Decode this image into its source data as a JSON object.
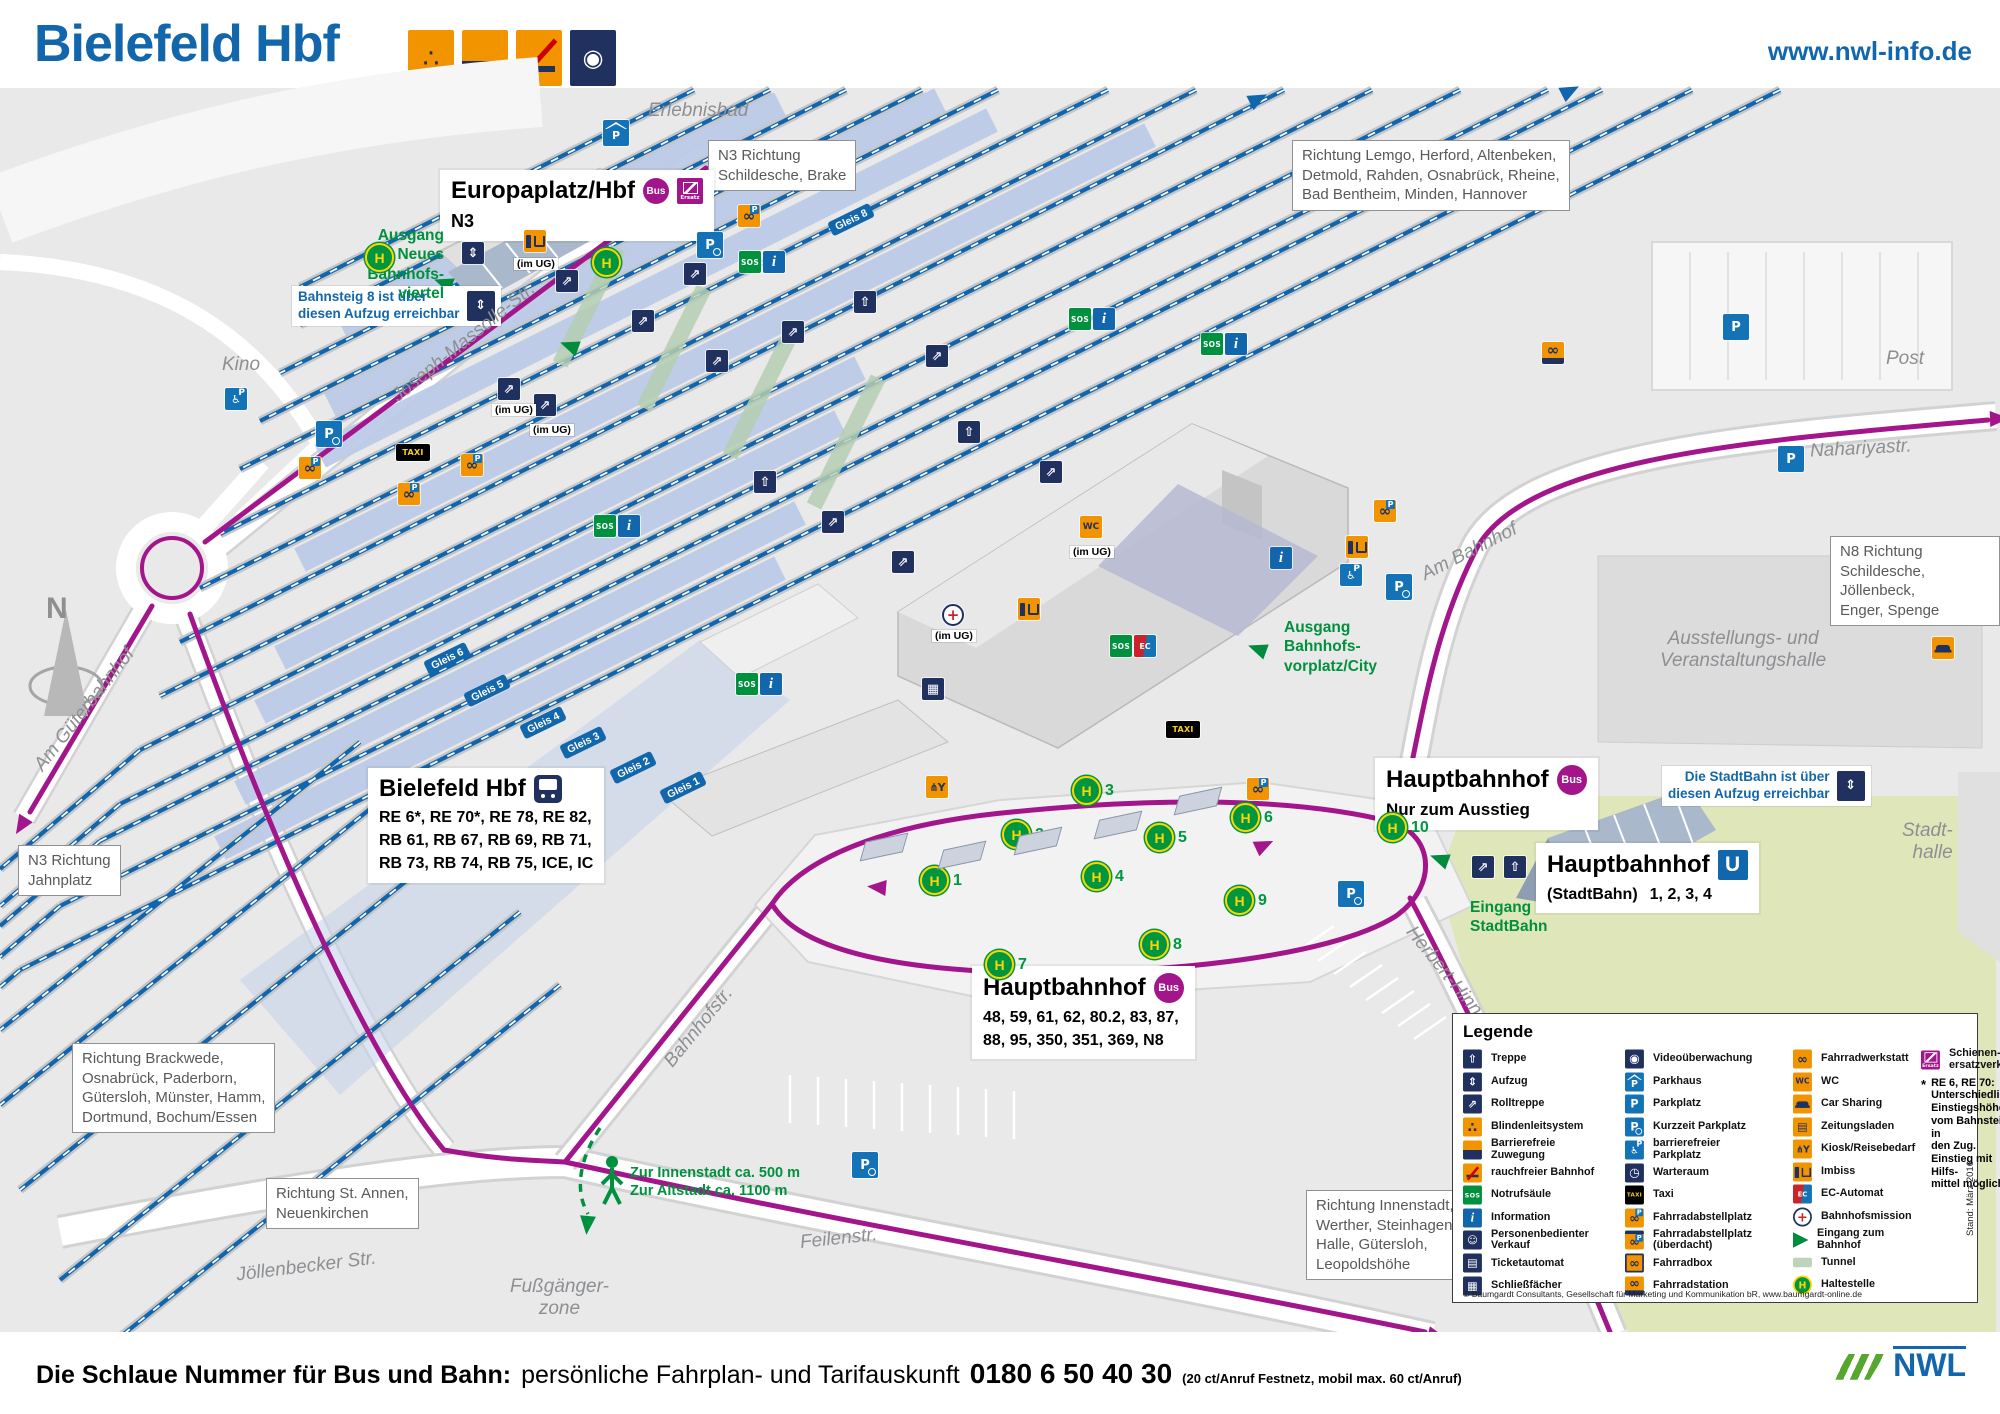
{
  "header": {
    "title": "Bielefeld Hbf",
    "website": "www.nwl-info.de"
  },
  "map": {
    "compass": "N",
    "taxi": "TAXI",
    "im_ug": "(im UG)",
    "gleis": [
      "Gleis 8",
      "Gleis 6",
      "Gleis 5",
      "Gleis 4",
      "Gleis 3",
      "Gleis 2",
      "Gleis 1"
    ],
    "stops": [
      "1",
      "2",
      "3",
      "4",
      "5",
      "6",
      "7",
      "8",
      "9",
      "10"
    ],
    "stations": {
      "europaplatz": {
        "title": "Europaplatz/Hbf",
        "badge": "Bus",
        "line": "N3"
      },
      "bielefeld": {
        "title": "Bielefeld Hbf",
        "lines": "RE 6*, RE 70*, RE 78, RE 82,\nRB 61, RB 67, RB 69, RB 71,\nRB 73, RB 74, RB 75, ICE, IC"
      },
      "hbf_exit": {
        "title": "Hauptbahnhof",
        "badge": "Bus",
        "note": "Nur zum Ausstieg"
      },
      "hbf_u": {
        "title": "Hauptbahnhof",
        "badge": "U",
        "sub": "(StadtBahn)",
        "lines": "1, 2, 3, 4"
      },
      "hbf_bus": {
        "title": "Hauptbahnhof",
        "badge": "Bus",
        "lines": "48, 59, 61, 62, 80.2, 83, 87,\n88, 95, 350, 351, 369, N8"
      }
    },
    "directions": {
      "lemgo": "Richtung Lemgo, Herford, Altenbeken,\nDetmold, Rahden, Osnabrück, Rheine,\nBad Bentheim, Minden, Hannover",
      "n3_schildesche": "N3 Richtung\nSchildesche, Brake",
      "n3_jahnplatz": "N3 Richtung\nJahnplatz",
      "brackwede": "Richtung Brackwede,\nOsnabrück, Paderborn,\nGütersloh, Münster, Hamm,\nDortmund, Bochum/Essen",
      "st_annen": "Richtung St. Annen,\nNeuenkirchen",
      "innenstadt": "Richtung Innenstadt,\nWerther, Steinhagen,\nHalle, Gütersloh,\nLeopoldshöhe",
      "n8_schildesche": "N8 Richtung\nSchildesche, Jöllenbeck,\nEnger, Spenge"
    },
    "notes": {
      "bahnsteig8": "Bahnsteig 8 ist über\ndiesen Aufzug erreichbar",
      "stadtbahn": "Die StadtBahn ist über\ndiesen Aufzug erreichbar"
    },
    "green": {
      "viertel": "Ausgang\nNeues Bahnhofs-\nviertel",
      "vorplatz": "Ausgang\nBahnhofs-\nvorplatz/City",
      "eingang_sb": "Eingang\nStadtBahn",
      "walk": "Zur Innenstadt ca. 500 m\nZur Altstadt ca. 1100 m"
    },
    "places": {
      "erlebnisbad": "Erlebnisbad",
      "kino": "Kino",
      "post": "Post",
      "nahariya": "Nahariyastr.",
      "ausstellung": "Ausstellungs- und\nVeranstaltungshalle",
      "stadthalle": "Stadt-\nhalle",
      "am_gueterbahnhof": "Am Güterbahnhof",
      "joseph": "Joseph-Massolle-Str.",
      "bahnhofstr": "Bahnhofstr.",
      "feilenstr": "Feilenstr.",
      "joellenbecker": "Jöllenbecker Str.",
      "am_bahnhof": "Am Bahnhof",
      "herbert": "Herbert-Hinnen",
      "fussgaenger": "Fußgänger-\nzone"
    }
  },
  "legend": {
    "title": "Legende",
    "col1": [
      {
        "icon": "treppe",
        "label": "Treppe"
      },
      {
        "icon": "aufzug",
        "label": "Aufzug"
      },
      {
        "icon": "rolltreppe",
        "label": "Rolltreppe"
      },
      {
        "icon": "blinden",
        "label": "Blindenleitsystem"
      },
      {
        "icon": "barrierefrei",
        "label": "Barrierefreie\nZuwegung"
      },
      {
        "icon": "rauchfrei",
        "label": "rauchfreier Bahnhof"
      },
      {
        "icon": "sos",
        "label": "Notrufsäule"
      },
      {
        "icon": "info",
        "label": "Information"
      },
      {
        "icon": "verkauf",
        "label": "Personenbedienter\nVerkauf"
      },
      {
        "icon": "ticket",
        "label": "Ticketautomat"
      },
      {
        "icon": "locker",
        "label": "Schließfächer"
      }
    ],
    "col2": [
      {
        "icon": "video",
        "label": "Videoüberwachung"
      },
      {
        "icon": "parkhaus",
        "label": "Parkhaus"
      },
      {
        "icon": "p",
        "label": "Parkplatz"
      },
      {
        "icon": "pclock",
        "label": "Kurzzeit Parkplatz"
      },
      {
        "icon": "bfp",
        "label": "barrierefreier\nParkplatz"
      },
      {
        "icon": "warte",
        "label": "Warteraum"
      },
      {
        "icon": "taxi",
        "label": "Taxi"
      },
      {
        "icon": "bikep",
        "label": "Fahrradabstellplatz"
      },
      {
        "icon": "bikeproof",
        "label": "Fahrradabstellplatz\n(überdacht)"
      },
      {
        "icon": "bikebox",
        "label": "Fahrradbox"
      },
      {
        "icon": "bikestation",
        "label": "Fahrradstation"
      }
    ],
    "col3": [
      {
        "icon": "bikewerk",
        "label": "Fahrradwerkstatt"
      },
      {
        "icon": "wc",
        "label": "WC"
      },
      {
        "icon": "car",
        "label": "Car Sharing"
      },
      {
        "icon": "zeitung",
        "label": "Zeitungsladen"
      },
      {
        "icon": "kiosk",
        "label": "Kiosk/Reisebedarf"
      },
      {
        "icon": "imbiss",
        "label": "Imbiss"
      },
      {
        "icon": "ec",
        "label": "EC-Automat"
      },
      {
        "icon": "mission",
        "label": "Bahnhofsmission"
      },
      {
        "icon": "eingang",
        "label": "Eingang zum\nBahnhof"
      },
      {
        "icon": "tunnel",
        "label": "Tunnel"
      },
      {
        "icon": "haltestelle",
        "label": "Haltestelle"
      }
    ],
    "col4_icon": "ersatz",
    "col4_label": "Schienen-\nersatzverkehr",
    "note_star": "*",
    "note_title": "RE 6, RE 70:",
    "note_body": "Unterschiedliche\nEinstiegshöhen\nvom Bahnsteig in\nden Zug.\nEinstieg mit Hilfs-\nmittel möglich.",
    "copyright": "© Baumgardt Consultants, Gesellschaft für Marketing und Kommunikation bR, www.baumgardt-online.de",
    "stand": "Stand: März 2016"
  },
  "footer": {
    "bold": "Die Schlaue Nummer für Bus und Bahn:",
    "regular": "persönliche Fahrplan- und Tarifauskunft",
    "phone": "0180 6 50 40 30",
    "small": "(20 ct/Anruf Festnetz, mobil max. 60 ct/Anruf)",
    "logo_text": "NWL"
  }
}
